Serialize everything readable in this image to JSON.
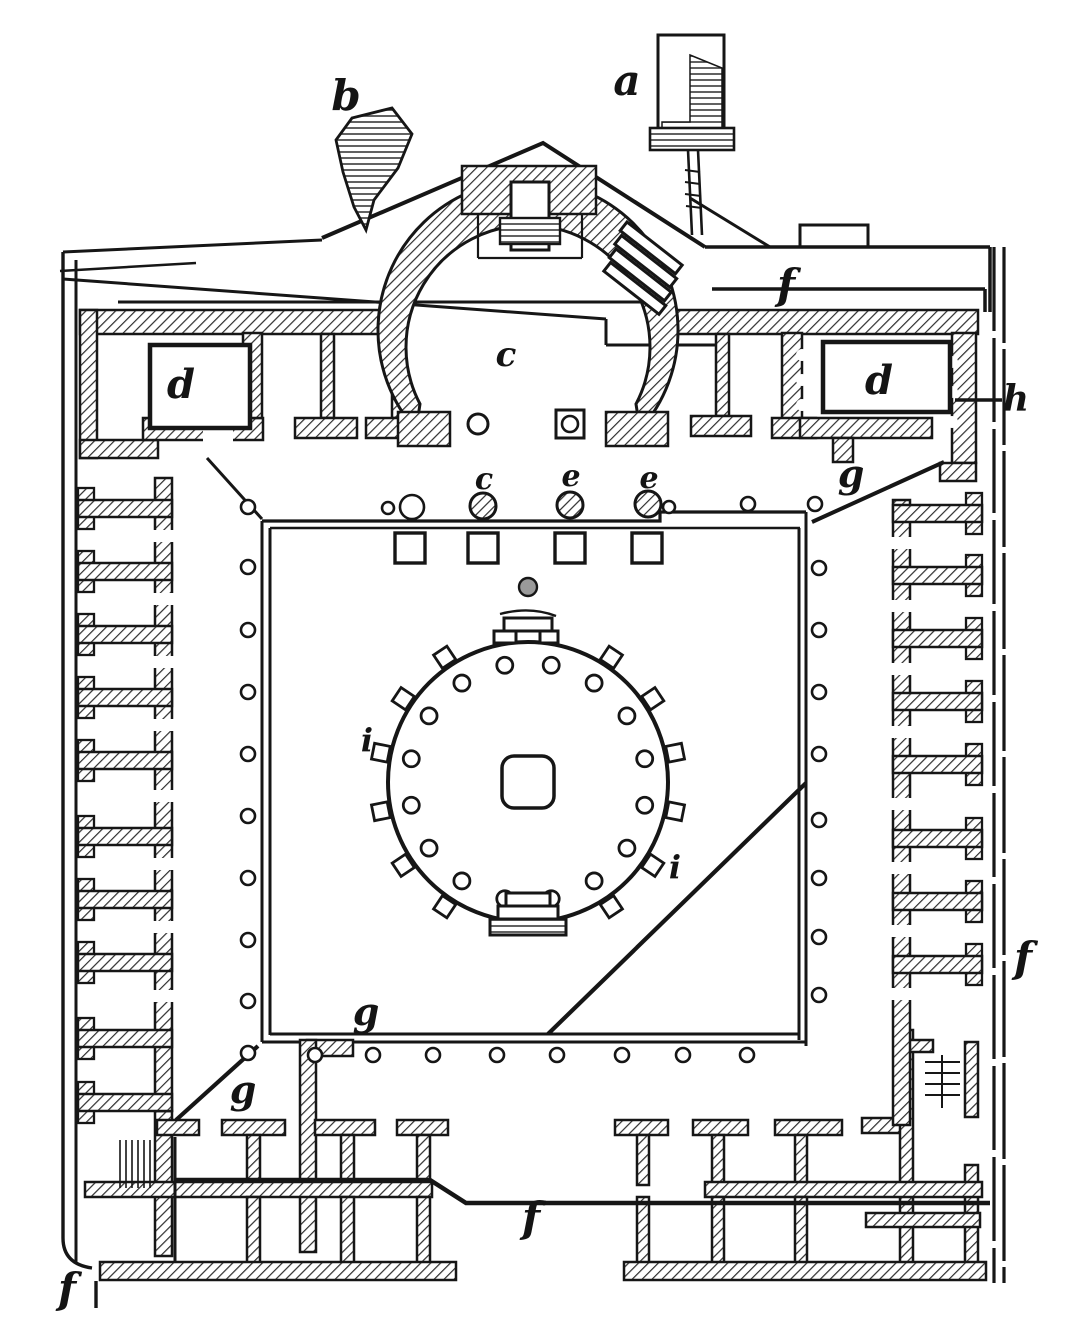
{
  "figure": {
    "description": "Engraved ground plan of a Roman market building (macellum) with a central circular tholos, surrounding colonnaded court, side shop ranges and an apsidal shrine at top",
    "ink_color": "#161616",
    "paper_color": "#ffffff"
  },
  "labels": [
    {
      "id": "a",
      "text": "a",
      "x": 627,
      "y": 95,
      "size": 42
    },
    {
      "id": "b",
      "text": "b",
      "x": 346,
      "y": 110,
      "size": 42
    },
    {
      "id": "c-apse",
      "text": "c",
      "x": 506,
      "y": 366,
      "size": 34
    },
    {
      "id": "c-base",
      "text": "c",
      "x": 484,
      "y": 489,
      "size": 30
    },
    {
      "id": "e-base-1",
      "text": "e",
      "x": 571,
      "y": 486,
      "size": 30
    },
    {
      "id": "e-base-2",
      "text": "e",
      "x": 649,
      "y": 488,
      "size": 30
    },
    {
      "id": "d-left",
      "text": "d",
      "x": 181,
      "y": 398,
      "size": 40
    },
    {
      "id": "d-right",
      "text": "d",
      "x": 879,
      "y": 394,
      "size": 40
    },
    {
      "id": "f-top",
      "text": "f",
      "x": 786,
      "y": 299,
      "size": 42
    },
    {
      "id": "f-right",
      "text": "f",
      "x": 1023,
      "y": 972,
      "size": 42
    },
    {
      "id": "f-bottom",
      "text": "f",
      "x": 531,
      "y": 1232,
      "size": 42
    },
    {
      "id": "f-corner",
      "text": "f",
      "x": 67,
      "y": 1303,
      "size": 42
    },
    {
      "id": "g-right",
      "text": "g",
      "x": 851,
      "y": 487,
      "size": 38
    },
    {
      "id": "g-bottom",
      "text": "g",
      "x": 366,
      "y": 1025,
      "size": 38
    },
    {
      "id": "g-corner",
      "text": "g",
      "x": 243,
      "y": 1103,
      "size": 38
    },
    {
      "id": "h",
      "text": "h",
      "x": 1016,
      "y": 411,
      "size": 36
    },
    {
      "id": "i-left",
      "text": "i",
      "x": 367,
      "y": 751,
      "size": 32
    },
    {
      "id": "i-right",
      "text": "i",
      "x": 675,
      "y": 878,
      "size": 32
    }
  ]
}
